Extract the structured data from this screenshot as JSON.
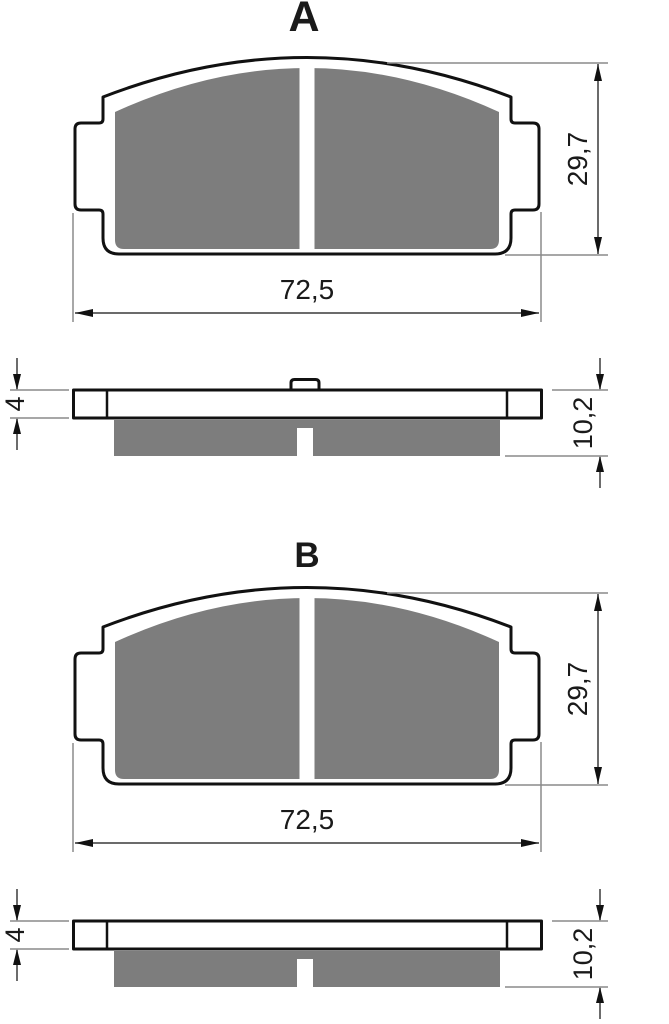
{
  "drawing": {
    "background": "#ffffff",
    "colors": {
      "outline": "#111111",
      "friction": "#7d7d7d",
      "dim_line": "#3a3a3a",
      "extension_line": "#8a8a8a",
      "text": "#1a1a1a"
    },
    "sections": [
      {
        "label": "A",
        "front_view": {
          "width": "72,5",
          "height": "29,7"
        },
        "side_view": {
          "backplate_thickness": "4",
          "total_thickness": "10,2",
          "center_tab": true
        }
      },
      {
        "label": "B",
        "front_view": {
          "width": "72,5",
          "height": "29,7"
        },
        "side_view": {
          "backplate_thickness": "4",
          "total_thickness": "10,2",
          "center_tab": false
        }
      }
    ]
  }
}
